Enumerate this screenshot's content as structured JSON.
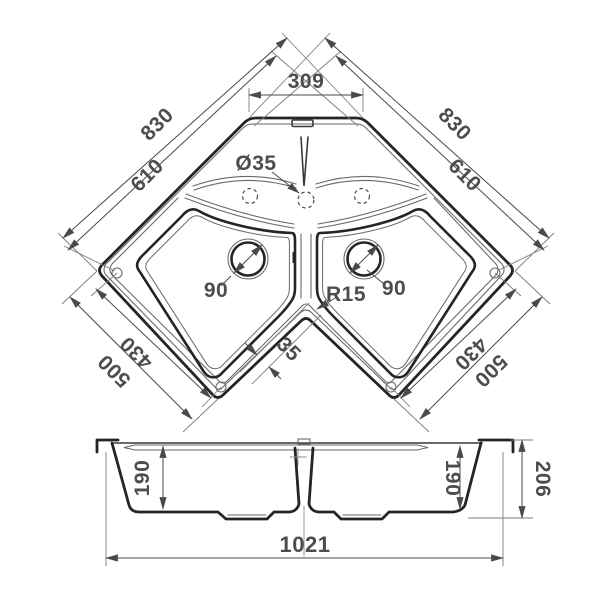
{
  "drawing": {
    "type": "technical-dimension-diagram",
    "subject": "corner double-bowl kitchen sink, top view and section view",
    "colors": {
      "line": "#262524",
      "text": "#4d4d4f",
      "thin_line": "#6a6a6a"
    },
    "top_view": {
      "labels": {
        "top_width": "309",
        "left_outer": "830",
        "left_inner": "610",
        "right_outer": "830",
        "right_inner": "610",
        "bottom_left_inner": "430",
        "bottom_left_outer": "500",
        "bottom_right_inner": "430",
        "bottom_right_outer": "500",
        "faucet_hole_diameter": "Ø35",
        "left_drain_diameter": "90",
        "right_drain_diameter": "90",
        "corner_radius": "R15",
        "divider_width": "35"
      }
    },
    "section_view": {
      "labels": {
        "left_bowl_depth": "190",
        "right_bowl_depth": "190",
        "overall_height": "206",
        "overall_length": "1021"
      }
    }
  }
}
